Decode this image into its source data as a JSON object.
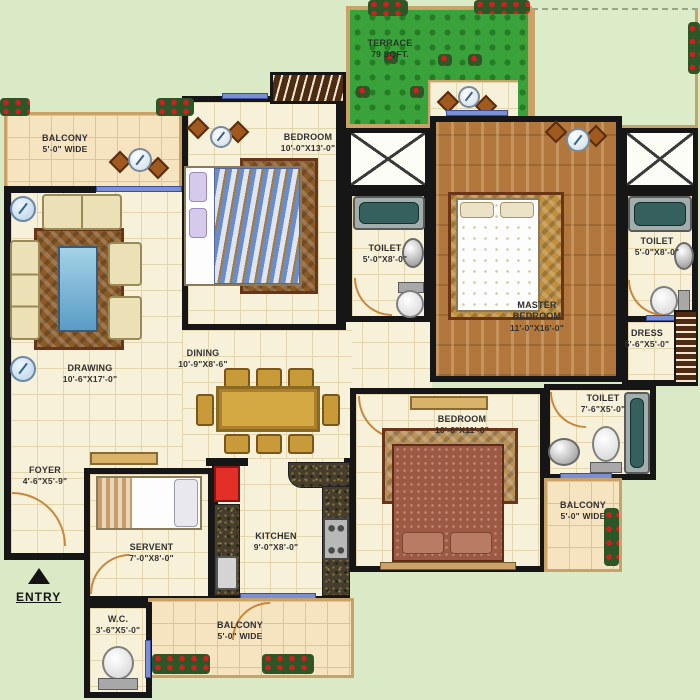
{
  "rooms": {
    "balcony_tl": {
      "name": "BALCONY",
      "size": "5'-0\" WIDE"
    },
    "drawing": {
      "name": "DRAWING",
      "size": "10'-6\"X17'-0\""
    },
    "bedroom_top": {
      "name": "BEDROOM",
      "size": "10'-0\"X13'-0\""
    },
    "terrace": {
      "name": "TERRACE",
      "size": "79 SQFT."
    },
    "toilet_mid": {
      "name": "TOILET",
      "size": "5'-0\"X8'-0\""
    },
    "master_bedroom": {
      "name": "MASTER BEDROOM",
      "size": "11'-0\"X16'-0\""
    },
    "toilet_right": {
      "name": "TOILET",
      "size": "5'-0\"X8'-0\""
    },
    "dress": {
      "name": "DRESS",
      "size": "5'-6\"X5'-0\""
    },
    "dining": {
      "name": "DINING",
      "size": "10'-9\"X8'-6\""
    },
    "foyer": {
      "name": "FOYER",
      "size": "4'-6\"X5'-9\""
    },
    "servant": {
      "name": "SERVENT",
      "size": "7'-0\"X8'-0\""
    },
    "kitchen": {
      "name": "KITCHEN",
      "size": "9'-0\"X8'-0\""
    },
    "bedroom_bottom": {
      "name": "BEDROOM",
      "size": "10'-6\"X11'-0\""
    },
    "toilet_bottom": {
      "name": "TOILET",
      "size": "7'-6\"X5'-0\""
    },
    "balcony_right": {
      "name": "BALCONY",
      "size": "5'-0\" WIDE"
    },
    "balcony_bottom": {
      "name": "BALCONY",
      "size": "5'-0\" WIDE"
    },
    "wc": {
      "name": "W.C.",
      "size": "3'-6\"X5'-0\""
    }
  },
  "entry": {
    "label": "ENTRY"
  },
  "colors": {
    "background": "#dbeac6",
    "floor_tile": "#f8f1da",
    "balcony_floor": "#f6e3bf",
    "wall": "#161616",
    "terrace_green": "#3aa23a",
    "wood_floor": "#b1773c",
    "border_tan": "#c9a268",
    "window_blue": "#7b8fd4",
    "bathtub_teal": "#35605e",
    "fridge_red": "#e23028"
  }
}
